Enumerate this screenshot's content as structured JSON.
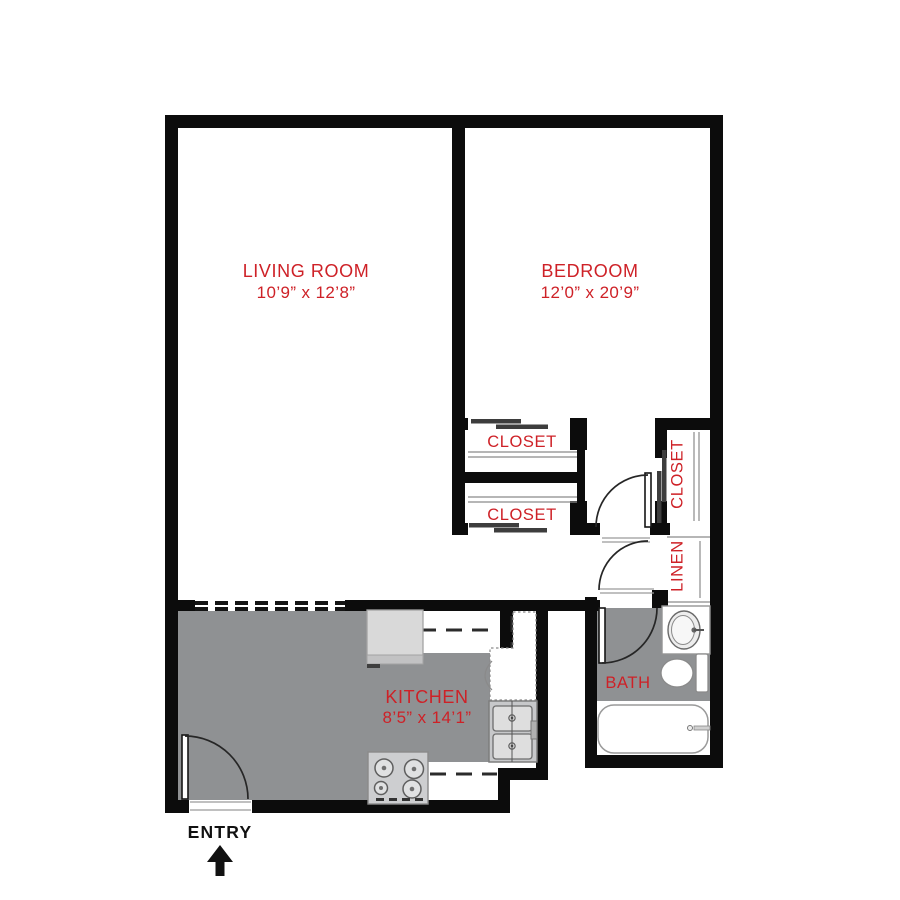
{
  "plan": {
    "type": "apartment-floor-plan",
    "colors": {
      "label_red": "#ce2127",
      "wall_black": "#0c0c0c",
      "floor_gray": "#8f9193"
    },
    "rooms": {
      "living_room": {
        "name": "LIVING ROOM",
        "dims": "10’9” x 12’8”"
      },
      "bedroom": {
        "name": "BEDROOM",
        "dims": "12’0” x 20’9”"
      },
      "kitchen": {
        "name": "KITCHEN",
        "dims": "8’5” x 14’1”"
      },
      "bath": {
        "name": "BATH"
      },
      "closet_top": {
        "name": "CLOSET"
      },
      "closet_bottom": {
        "name": "CLOSET"
      },
      "closet_bedroom": {
        "name": "CLOSET"
      },
      "linen": {
        "name": "LINEN"
      },
      "entry": {
        "name": "ENTRY",
        "arrow_icon": "up-arrow"
      }
    }
  }
}
